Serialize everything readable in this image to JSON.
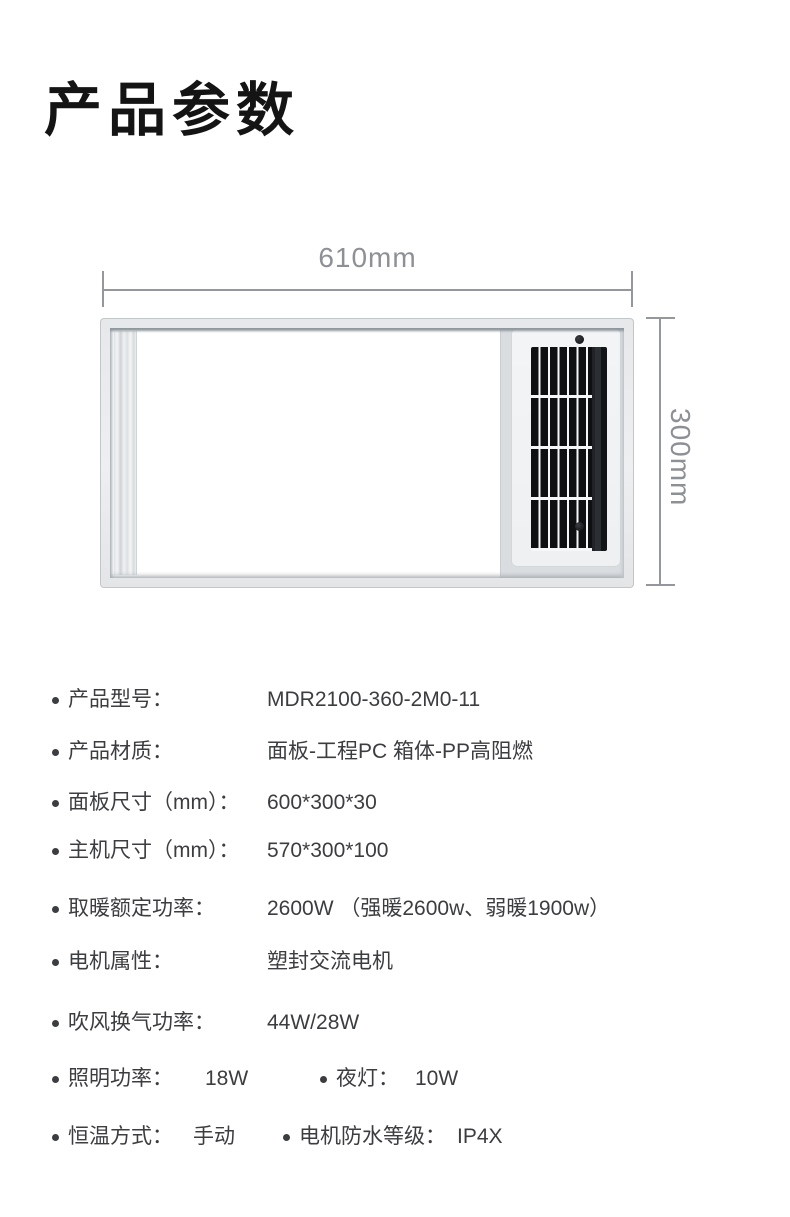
{
  "page": {
    "title": "产品参数"
  },
  "diagram": {
    "width_label": "610mm",
    "height_label": "300mm"
  },
  "specs": {
    "rows": [
      {
        "label": "产品型号：",
        "value": "MDR2100-360-2M0-11"
      },
      {
        "label": "产品材质：",
        "value": "面板-工程PC 箱体-PP高阻燃"
      },
      {
        "label": "面板尺寸（mm）：",
        "value": "600*300*30"
      },
      {
        "label": "主机尺寸（mm）：",
        "value": "570*300*100"
      },
      {
        "label": "取暖额定功率：",
        "value": "2600W （强暖2600w、弱暖1900w）"
      },
      {
        "label": "电机属性：",
        "value": "塑封交流电机"
      },
      {
        "label": "吹风换气功率：",
        "value": "44W/28W"
      },
      {
        "label": "照明功率：",
        "value": "18W",
        "label2": "夜灯：",
        "value2": "10W"
      },
      {
        "label": "恒温方式：",
        "value": "手动",
        "label2": "电机防水等级：",
        "value2": "IP4X"
      }
    ]
  },
  "colors": {
    "title_text": "#141414",
    "body_text": "#3c3d40",
    "dimension_gray": "#8d9094",
    "frame_gray": "#e9ebec",
    "grille_dark": "#0f1012"
  }
}
